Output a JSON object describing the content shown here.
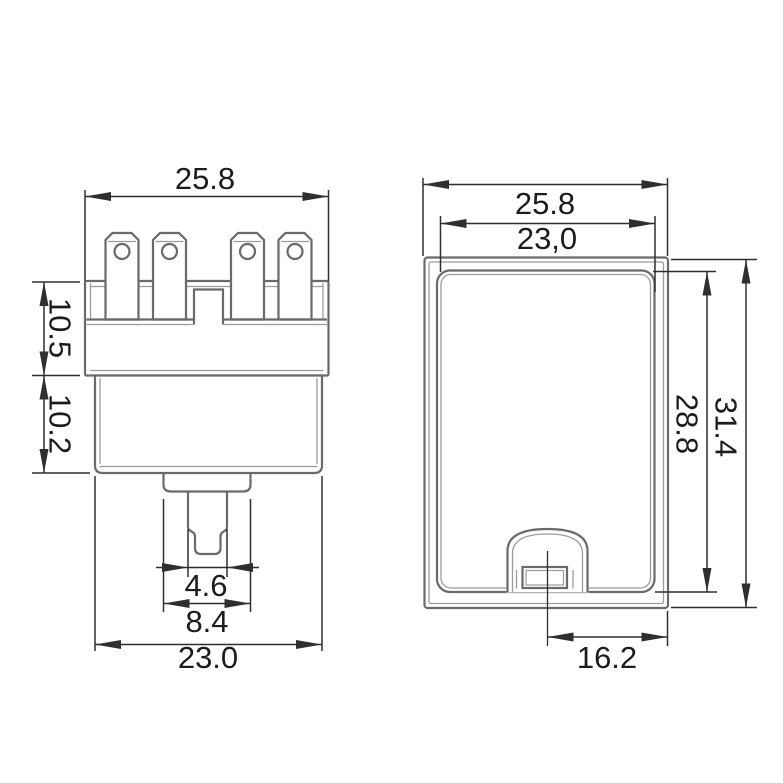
{
  "drawing": {
    "kind": "technical-dimension-drawing",
    "views": {
      "front": {
        "dims": {
          "top_width": "25.8",
          "upper_height": "10.5",
          "lower_height": "10.2",
          "stem_width": "4.6",
          "collar_width": "8.4",
          "bottom_width": "23.0"
        }
      },
      "side": {
        "dims": {
          "outer_width": "25.8",
          "inner_width": "23,0",
          "inner_height": "28.8",
          "outer_height": "31.4",
          "slot_offset": "16.2"
        }
      }
    },
    "colors": {
      "background": "#ffffff",
      "outline": "#6a6a6a",
      "outline_light": "#9b9b9b",
      "dimension": "#2f2f2f",
      "text": "#1c1c1c"
    }
  }
}
